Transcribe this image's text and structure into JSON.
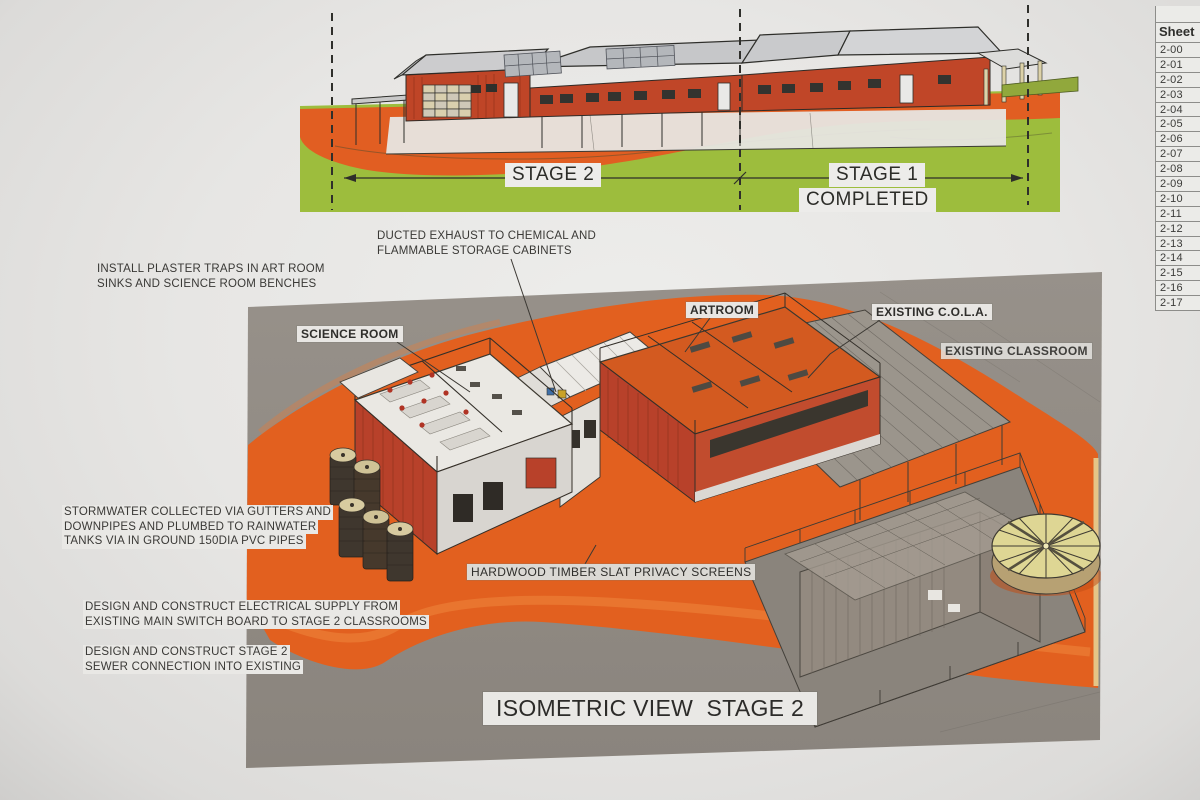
{
  "sheet_table": {
    "header": "Sheet",
    "rows": [
      "2-00",
      "2-01",
      "2-02",
      "2-03",
      "2-04",
      "2-05",
      "2-06",
      "2-07",
      "2-08",
      "2-09",
      "2-10",
      "2-11",
      "2-12",
      "2-13",
      "2-14",
      "2-15",
      "2-16",
      "2-17"
    ]
  },
  "elevation": {
    "stage2": "STAGE 2",
    "stage1": "STAGE 1",
    "completed": "COMPLETED"
  },
  "isometric": {
    "title": "ISOMETRIC VIEW  STAGE 2",
    "label_science_room": "SCIENCE ROOM",
    "label_artroom": "ARTROOM",
    "label_existing_cola": "EXISTING C.O.L.A.",
    "label_existing_classroom": "EXISTING CLASSROOM",
    "label_privacy_screens": "HARDWOOD TIMBER SLAT PRIVACY SCREENS"
  },
  "annotations": {
    "plaster_traps": [
      "INSTALL PLASTER TRAPS IN ART ROOM",
      "SINKS AND SCIENCE ROOM BENCHES"
    ],
    "ducted_exhaust": [
      "DUCTED EXHAUST TO CHEMICAL AND",
      "FLAMMABLE STORAGE CABINETS"
    ],
    "stormwater": [
      "STORMWATER COLLECTED VIA GUTTERS AND",
      "DOWNPIPES AND PLUMBED TO RAINWATER",
      "TANKS VIA IN GROUND 150DIA PVC PIPES"
    ],
    "electrical": [
      "DESIGN AND CONSTRUCT ELECTRICAL SUPPLY FROM",
      "EXISTING MAIN SWITCH BOARD TO STAGE 2 CLASSROOMS"
    ],
    "sewer": [
      "DESIGN AND CONSTRUCT STAGE 2",
      "SEWER CONNECTION INTO EXISTING"
    ]
  },
  "colors": {
    "paper": "#e7e6e4",
    "grass_green": "#9dbd3d",
    "track_orange": "#e2601f",
    "building_red": "#bf4527",
    "panel_gray": "#8f8983",
    "roof_gray": "#c9cacc",
    "tank_tan": "#d8cba0"
  }
}
